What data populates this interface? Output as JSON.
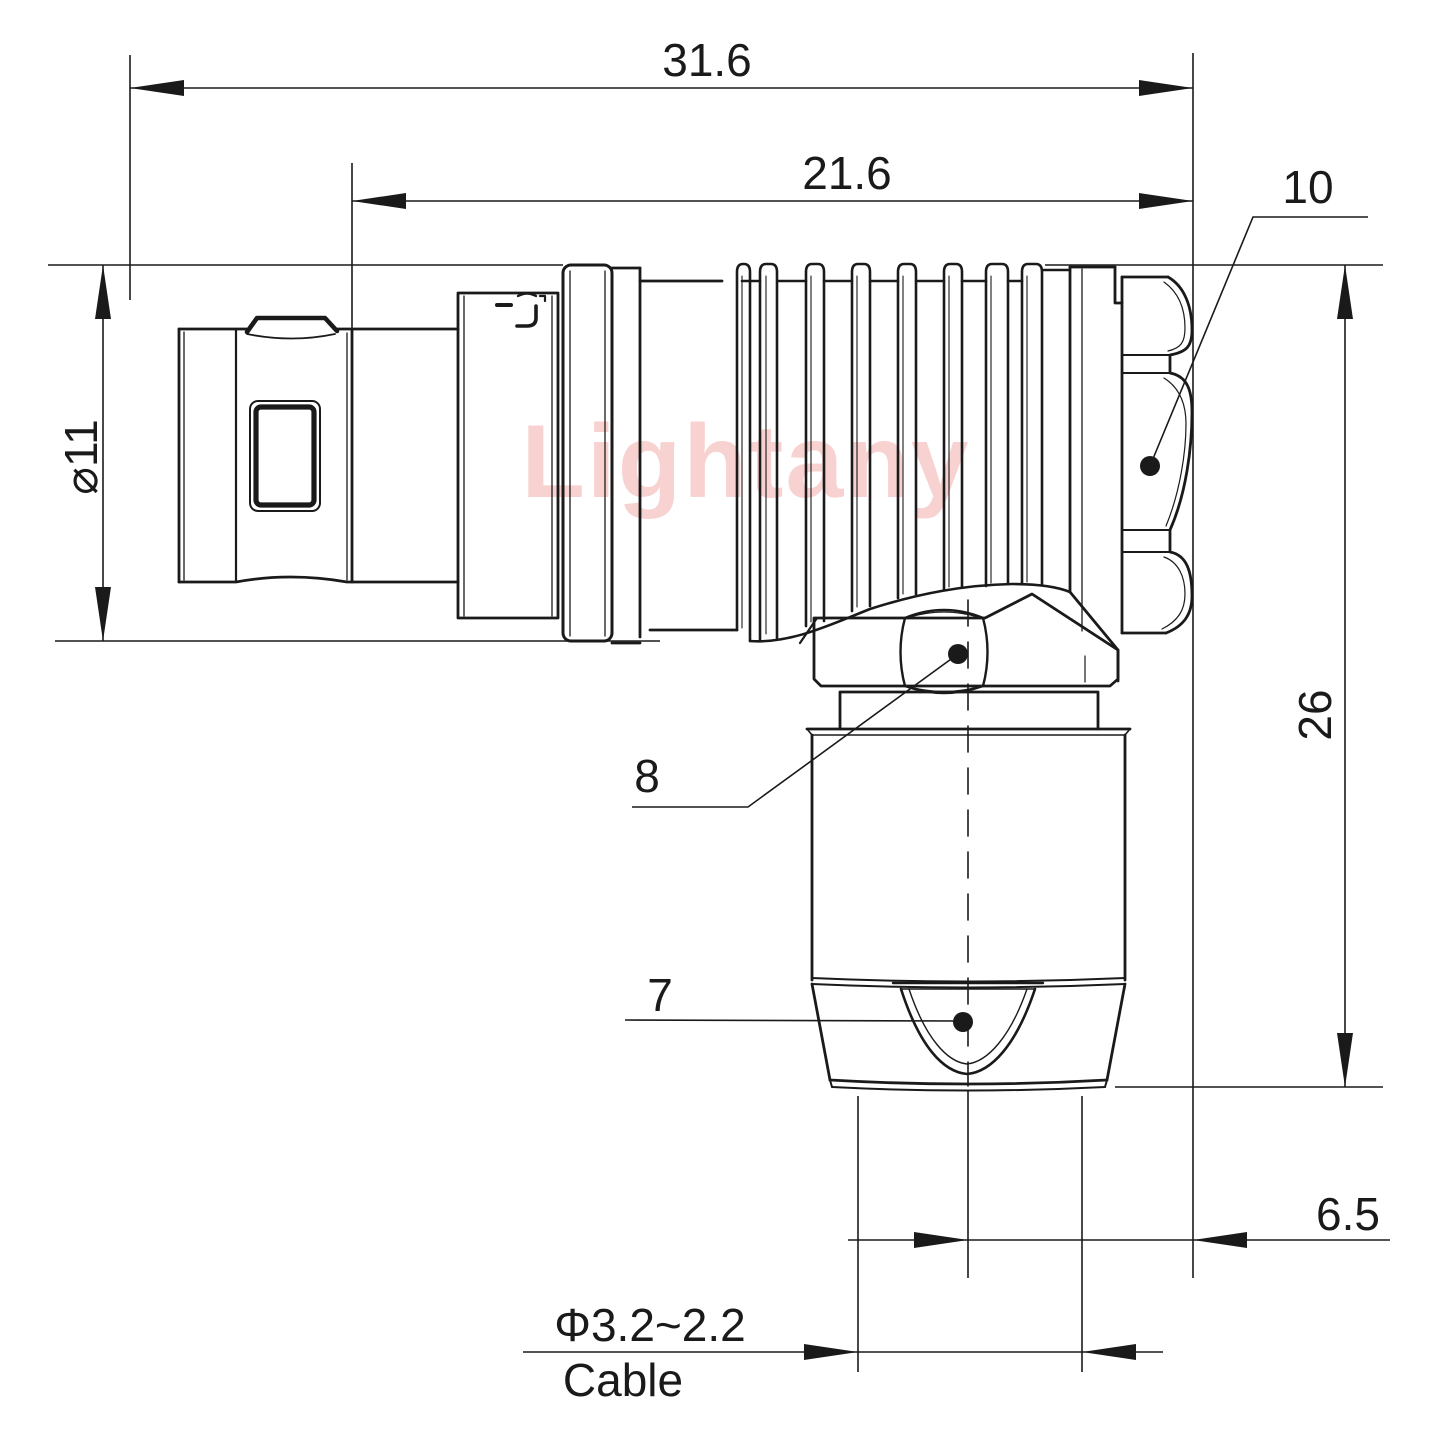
{
  "page": {
    "background": "#ffffff"
  },
  "watermark": {
    "text": "Lightany",
    "color": "#f8d2d0"
  },
  "drawing": {
    "line_color": "#1a1a1a",
    "dimensions": {
      "overall_length": "31.6",
      "front_length": "21.6",
      "rear_diameter": "⌀11",
      "total_height": "26",
      "exit_offset": "6.5",
      "cable_diameter": "Φ3.2~2.2",
      "cable_word": "Cable"
    },
    "callouts": {
      "end_nut": "10",
      "coupling_nut": "8",
      "strain_relief": "7"
    }
  }
}
